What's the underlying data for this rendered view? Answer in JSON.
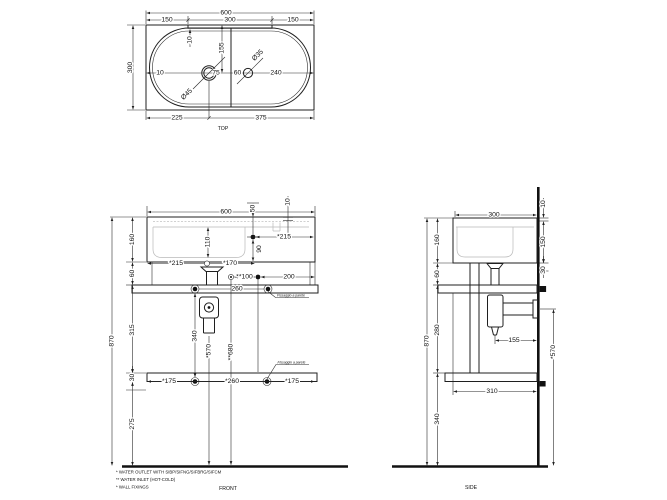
{
  "meta": {
    "background": "#ffffff",
    "line_color": "#1f1f1f",
    "light_line_color": "#b9b9b9"
  },
  "top_view": {
    "caption": "TOP",
    "dims": {
      "width_total": "600",
      "back_left": "150",
      "back_center": "300",
      "back_right": "150",
      "slot_offset": "10",
      "center_offset": "155",
      "depth_total": "300",
      "edge_gap": "10",
      "tap_hole_dia": "Ø45",
      "tap_to_divider": "75",
      "divider_to_inlet": "60",
      "inlet_dia": "Ø35",
      "inlet_to_edge": "240",
      "left_to_tap": "225",
      "tap_to_right": "375"
    }
  },
  "front_view": {
    "caption": "FRONT",
    "dims": {
      "width_total": "600",
      "top_offset": "50",
      "slot_width": "10",
      "bowl_depth": "110",
      "inlet_to_right": "*215",
      "inlet_drop": "90",
      "basin_height": "160",
      "outlet_from_left": "*215",
      "outlet_to_inlet": "*170",
      "basin_to_rail": "60",
      "inlet_pair": "**100",
      "inlet_to_edge": "200",
      "rail_fix_span": "260",
      "rail_to_shelf": "315",
      "shelf_thickness": "30",
      "fix_vertical_span": "340",
      "outlet_height": "*570",
      "inlet_height": "**680",
      "shelf_left": "*175",
      "shelf_fix_span": "*260",
      "shelf_right": "*175",
      "shelf_to_floor": "275",
      "total_height": "870"
    },
    "annotations": {
      "wall_fix_upper": "Fissaggio a parete",
      "wall_fix_lower": "Fissaggio a parete"
    }
  },
  "side_view": {
    "caption": "SIDE",
    "dims": {
      "depth_total": "300",
      "slot_offset": "10",
      "back_drop": "150",
      "bracket": "30",
      "basin_height": "160",
      "basin_to_rail": "60",
      "rail_to_shelf": "280",
      "total_height": "870",
      "trap_offset": "155",
      "outlet_height": "*570",
      "shelf_depth": "310",
      "shelf_to_floor": "340"
    }
  },
  "footnotes": [
    "* WATER OUTLET WITH SIBP/SIFNG/SIFBRG/SIFCM",
    "** WATER INLET  (HOT-COLD)",
    "* WALL FIXINGS"
  ]
}
